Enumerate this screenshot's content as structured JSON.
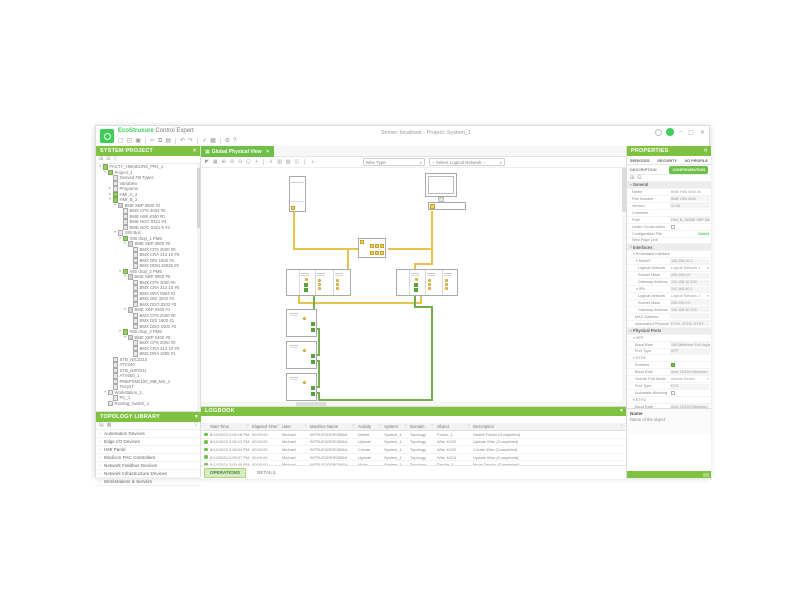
{
  "window": {
    "app_brand": "EcoStruxure",
    "app_name": "Control Expert",
    "title": "Server: localhost - Project: System_1",
    "controls": {
      "minimize": "–",
      "maximize": "▢",
      "close": "✕"
    }
  },
  "title_toolbar": {
    "icons": [
      "new",
      "open",
      "save",
      "sep",
      "cut",
      "copy",
      "paste",
      "sep",
      "undo",
      "redo",
      "sep",
      "validate",
      "build",
      "sep",
      "settings",
      "help"
    ]
  },
  "system_panel": {
    "title": "SYSTEM PROJECT",
    "close_icon": "✕",
    "toolbar_icons": [
      "expand-all",
      "collapse-all",
      "filter"
    ],
    "tree": [
      {
        "label": "FACTY_HMI4EURS_PRJ_1",
        "level": 0,
        "state": "expanded",
        "icon": "project"
      },
      {
        "label": "Project_1",
        "level": 1,
        "state": "expanded",
        "icon": "project"
      },
      {
        "label": "Derived FB Types",
        "level": 2,
        "state": "leaf",
        "icon": "folder"
      },
      {
        "label": "Variables",
        "level": 2,
        "state": "leaf",
        "icon": "folder"
      },
      {
        "label": "Programs",
        "level": 2,
        "state": "collapsed",
        "icon": "folder"
      },
      {
        "label": "HMI_A_2",
        "level": 2,
        "state": "collapsed",
        "icon": "hmi"
      },
      {
        "label": "HMI_B_2",
        "level": 2,
        "state": "expanded",
        "icon": "hmi"
      },
      {
        "label": "BME XBP 0800 #2",
        "level": 3,
        "state": "expanded",
        "icon": "rack"
      },
      {
        "label": "BMX CPS 4002 #0",
        "level": 4,
        "state": "leaf",
        "icon": "module"
      },
      {
        "label": "BME H58 4040 #0",
        "level": 4,
        "state": "leaf",
        "icon": "module"
      },
      {
        "label": "BME NOC 0321 #3",
        "level": 4,
        "state": "leaf",
        "icon": "module"
      },
      {
        "label": "BME NOC 0321.9 #4",
        "level": 4,
        "state": "leaf",
        "icon": "module"
      },
      {
        "label": "X80 Bus",
        "level": 3,
        "state": "expanded",
        "icon": "bus"
      },
      {
        "label": "X80 drop_1 PME",
        "level": 4,
        "state": "expanded",
        "icon": "drop"
      },
      {
        "label": "BME XBP 0800 #0",
        "level": 5,
        "state": "expanded",
        "icon": "rack"
      },
      {
        "label": "BMX CPS 2000 #0",
        "level": 6,
        "state": "leaf",
        "icon": "module"
      },
      {
        "label": "BMX CRA 312 10 #0",
        "level": 6,
        "state": "leaf",
        "icon": "module"
      },
      {
        "label": "BMX DDI 1602 #1",
        "level": 6,
        "state": "leaf",
        "icon": "module"
      },
      {
        "label": "BMX DDM 16025 #2",
        "level": 6,
        "state": "leaf",
        "icon": "module"
      },
      {
        "label": "X80 drop_2 PME",
        "level": 4,
        "state": "expanded",
        "icon": "drop"
      },
      {
        "label": "BME XBP 0800 #0",
        "level": 5,
        "state": "expanded",
        "icon": "rack"
      },
      {
        "label": "BMX CPS 2000 #0",
        "level": 6,
        "state": "leaf",
        "icon": "module"
      },
      {
        "label": "BMX CRA 312 10 #0",
        "level": 6,
        "state": "leaf",
        "icon": "module"
      },
      {
        "label": "BMX DRA 0804 #1",
        "level": 6,
        "state": "leaf",
        "icon": "module"
      },
      {
        "label": "BMX DDI 3202 #2",
        "level": 6,
        "state": "leaf",
        "icon": "module"
      },
      {
        "label": "BMX DDO 3202 #3",
        "level": 6,
        "state": "leaf",
        "icon": "module"
      },
      {
        "label": "BME XBP 0400 #1",
        "level": 5,
        "state": "expanded",
        "icon": "rack"
      },
      {
        "label": "BMX CPS 2000 #0",
        "level": 6,
        "state": "leaf",
        "icon": "module"
      },
      {
        "label": "BMX DDI 1602 #1",
        "level": 6,
        "state": "leaf",
        "icon": "module"
      },
      {
        "label": "BMX DDO 1602 #2",
        "level": 6,
        "state": "leaf",
        "icon": "module"
      },
      {
        "label": "X80 drop_3 PME",
        "level": 4,
        "state": "expanded",
        "icon": "drop"
      },
      {
        "label": "BME XBP 0400 #0",
        "level": 5,
        "state": "expanded",
        "icon": "rack"
      },
      {
        "label": "BMX CPS 2000 #0",
        "level": 6,
        "state": "leaf",
        "icon": "module"
      },
      {
        "label": "BMX CRA 312 10 #0",
        "level": 6,
        "state": "leaf",
        "icon": "module"
      },
      {
        "label": "BMX DRA 1605 #1",
        "level": 6,
        "state": "leaf",
        "icon": "module"
      },
      {
        "label": "STB_NIC2212",
        "level": 2,
        "state": "leaf",
        "icon": "device"
      },
      {
        "label": "ATV340",
        "level": 2,
        "state": "leaf",
        "icon": "device"
      },
      {
        "label": "STB_NIP2311",
        "level": 2,
        "state": "leaf",
        "icon": "device"
      },
      {
        "label": "ATV600_1",
        "level": 2,
        "state": "leaf",
        "icon": "device"
      },
      {
        "label": "PMEPXM0100_MB_MS_1",
        "level": 2,
        "state": "leaf",
        "icon": "device"
      },
      {
        "label": "TeSysT",
        "level": 2,
        "state": "leaf",
        "icon": "device"
      },
      {
        "label": "Workstation_1",
        "level": 1,
        "state": "expanded",
        "icon": "pc"
      },
      {
        "label": "PC_1",
        "level": 2,
        "state": "leaf",
        "icon": "pc"
      },
      {
        "label": "Routing_Switch_1",
        "level": 1,
        "state": "leaf",
        "icon": "switch"
      }
    ]
  },
  "library_panel": {
    "title": "TOPOLOGY LIBRARY",
    "collapse_icon": "▾",
    "toolbar_icons": [
      "view-list",
      "view-grid"
    ],
    "filter_icon": "filter",
    "items": [
      "Automation Devices",
      "Edge I/O Devices",
      "HMI Panel",
      "Modicon PAC Controllers",
      "Network Fieldbus Devices",
      "Network Infrastructure Devices",
      "Workstations & Servers"
    ]
  },
  "canvas": {
    "tab_label": "Global Physical View",
    "tab_close": "✕",
    "toolbar_icons": [
      "pointer",
      "grid",
      "zoom-in",
      "zoom-out",
      "zoom-100",
      "zoom-fit",
      "pan",
      "sep",
      "export",
      "print",
      "copy-image",
      "layout",
      "sep",
      "hierarchy"
    ],
    "combos": {
      "wire_type": "Wire Type",
      "logical_network": "-- Select Logical Network --"
    },
    "devices": [
      "hmi-panel-device",
      "engineering-workstation",
      "ethernet-switch",
      "rack-main-a",
      "rack-main-b",
      "x80-drop-1",
      "x80-drop-2",
      "x80-drop-3"
    ]
  },
  "logbook": {
    "title": "LOGBOOK",
    "collapse_icon": "▾",
    "columns": [
      "Start Time",
      "Elapsed Time",
      "User",
      "Machine Name",
      "Activity",
      "System",
      "Domain",
      "Object",
      "Description"
    ],
    "rows": [
      [
        "8/14/2024 2:06:18 PM",
        "00:00:00",
        "Michael",
        "WTRUS3GER0506A",
        "Delete",
        "System_1",
        "Topology",
        "Folder_1",
        "Delete Folder (Completed)"
      ],
      [
        "8/14/2024 2:06:12 PM",
        "00:00:00",
        "Michael",
        "WTRUS3GER0506A",
        "Update",
        "System_1",
        "Topology",
        "Wire 4/209",
        "Update Wire (Completed)"
      ],
      [
        "8/14/2024 2:06:04 PM",
        "00:00:00",
        "Michael",
        "WTRUS3GER0506A",
        "Create",
        "System_1",
        "Topology",
        "Wire 4/209",
        "Create Wire (Completed)"
      ],
      [
        "8/14/2024 2:05:57 PM",
        "00:00:00",
        "Michael",
        "WTRUS3GER0506A",
        "Update",
        "System_1",
        "Topology",
        "Wire 4/214",
        "Update Wire (Completed)"
      ],
      [
        "8/14/2024 2:05:49 PM",
        "00:00:00",
        "Michael",
        "WTRUS3GER0506A",
        "Move",
        "System_1",
        "Topology",
        "Device_1",
        "Move Device (Completed)"
      ]
    ],
    "tabs": [
      {
        "label": "OPERATIONS",
        "active": true
      },
      {
        "label": "DETAILS",
        "active": false
      }
    ]
  },
  "properties": {
    "title": "PROPERTIES",
    "close_icon": "✕",
    "tabs": [
      "SERVICES",
      "SECURITY",
      "I/O PROFILE"
    ],
    "description_tab": "DESCRIPTION",
    "configuration_tab": "CONFIGURATION",
    "toolbar_icons": [
      "expand-all",
      "collapse-all"
    ],
    "rows": [
      {
        "kind": "section",
        "label": "General"
      },
      {
        "label": "Name",
        "value": "BME H58 4040 #0",
        "type": "edit",
        "indent": 1
      },
      {
        "label": "Part Number",
        "value": "BME H58 4040",
        "type": "ro",
        "indent": 1
      },
      {
        "label": "Version",
        "value": "01.00",
        "type": "ro",
        "indent": 1
      },
      {
        "label": "Comment",
        "value": "",
        "type": "edit",
        "indent": 1
      },
      {
        "label": "Path",
        "value": "HMI_B_2\\BME XBP 0800 #2",
        "type": "ro",
        "indent": 1
      },
      {
        "label": "Under Construction",
        "type": "checkbox",
        "checked": false,
        "indent": 1
      },
      {
        "label": "Configuration File",
        "value": "Select",
        "type": "link",
        "indent": 1
      },
      {
        "label": "Web Page Link",
        "value": "",
        "type": "edit",
        "indent": 1
      },
      {
        "kind": "section",
        "label": "Interfaces"
      },
      {
        "kind": "group",
        "label": "Embedded Interface",
        "indent": 1
      },
      {
        "kind": "group",
        "label": "MainIP",
        "value": "192.168.10.1",
        "indent": 2
      },
      {
        "label": "Logical Network",
        "value": "Logical Network 1",
        "type": "dropdown",
        "indent": 3
      },
      {
        "label": "Subnet Mask",
        "value": "255.255.0.0",
        "type": "ro",
        "indent": 3
      },
      {
        "label": "Gateway Address",
        "value": "192.168.10.100",
        "type": "ro",
        "indent": 3
      },
      {
        "kind": "group",
        "label": "IPA",
        "value": "192.168.40.1",
        "indent": 2
      },
      {
        "label": "Logical Network",
        "value": "Logical Network 2",
        "type": "dropdown",
        "indent": 3
      },
      {
        "label": "Subnet Mask",
        "value": "255.255.0.0",
        "type": "ro",
        "indent": 3
      },
      {
        "label": "Gateway Address",
        "value": "192.168.40.100",
        "type": "ro",
        "indent": 3
      },
      {
        "label": "MAC Address",
        "value": "",
        "type": "ro",
        "indent": 2
      },
      {
        "label": "Associated Physical Ports",
        "value": "ETH1, ETH2, ETH3",
        "type": "ro",
        "indent": 2
      },
      {
        "kind": "section",
        "label": "Physical Ports"
      },
      {
        "kind": "group",
        "label": "SFP",
        "indent": 1
      },
      {
        "label": "Baud Rate",
        "value": "100 Mbits/sec Full duplex",
        "type": "ro",
        "indent": 2
      },
      {
        "label": "Port Type",
        "value": "SFP",
        "type": "ro",
        "indent": 2
      },
      {
        "kind": "group",
        "label": "ETH1",
        "indent": 1
      },
      {
        "label": "Enabled",
        "type": "checkbox",
        "checked": true,
        "indent": 2
      },
      {
        "label": "Baud Rate",
        "value": "Auto 10/100 Mbits/sec",
        "type": "ro",
        "indent": 2
      },
      {
        "label": "Secure Port Mode",
        "value": "Access Device",
        "type": "dropdown",
        "indent": 2
      },
      {
        "label": "Port Type",
        "value": "ETH",
        "type": "ro",
        "indent": 2
      },
      {
        "label": "Automatic Blocking",
        "type": "checkbox",
        "checked": false,
        "indent": 2
      },
      {
        "kind": "group",
        "label": "ETH2",
        "indent": 1
      },
      {
        "label": "Baud Rate",
        "value": "Auto 10/100 Mbits/sec",
        "type": "ro",
        "indent": 2
      },
      {
        "label": "LC Service",
        "value": "QoS, RSTP",
        "type": "dropdown",
        "indent": 2
      },
      {
        "label": "Port Type",
        "value": "ETH",
        "type": "ro",
        "indent": 2
      },
      {
        "kind": "group",
        "label": "ETH3",
        "indent": 1
      },
      {
        "label": "Baud Rate",
        "value": "Auto 10/100 Mbits/sec",
        "type": "ro",
        "indent": 2
      },
      {
        "label": "LC Service",
        "value": "QoS, RSTP",
        "type": "dropdown",
        "indent": 2
      }
    ],
    "help": {
      "title": "Name",
      "text": "Name of the object"
    }
  },
  "colors": {
    "accent_green": "#3dcd58",
    "header_green": "#7fc241",
    "wire_yellow": "#e6c34c",
    "wire_green": "#6fb04a"
  }
}
